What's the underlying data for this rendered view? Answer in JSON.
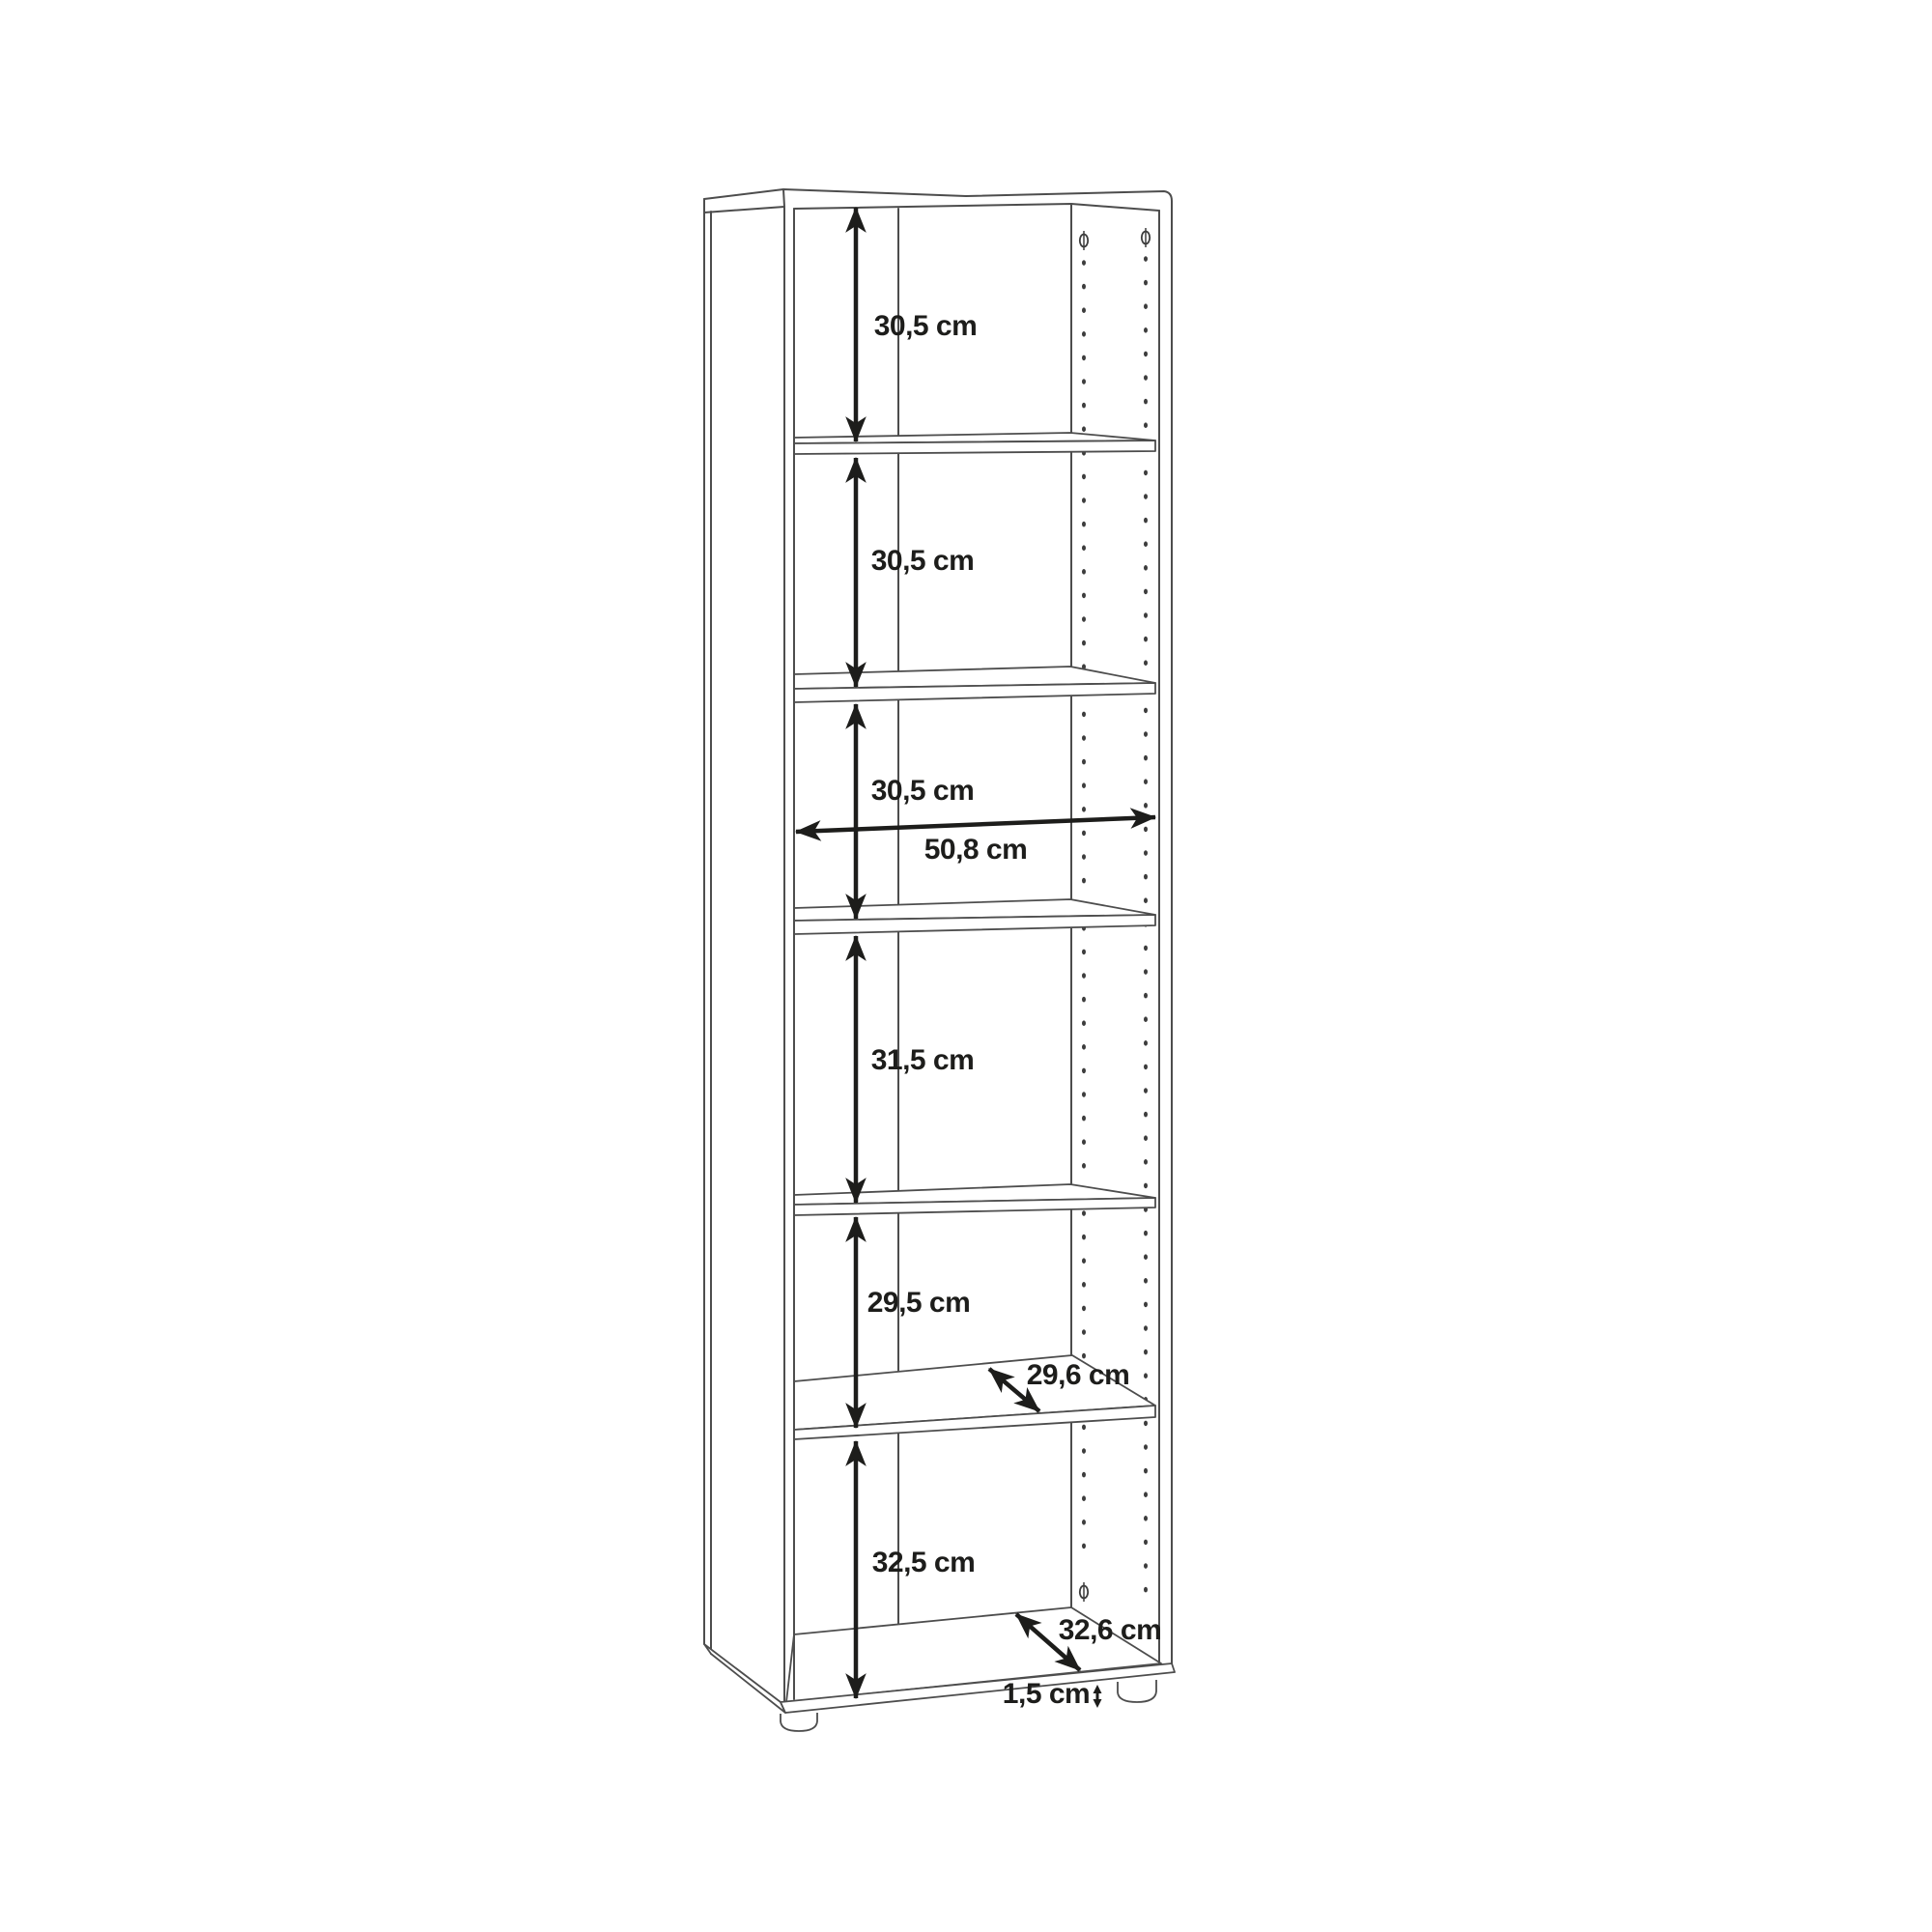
{
  "page": {
    "background": "#ffffff"
  },
  "diagram": {
    "subject": "bookcase-dimension-drawing",
    "line_color": "#4d4d4d",
    "dimension_color": "#1d1d1b",
    "shelf_count": 5,
    "dimensions": {
      "compartment_heights": [
        "30,5 cm",
        "30,5 cm",
        "30,5 cm",
        "31,5 cm",
        "29,5 cm",
        "32,5 cm"
      ],
      "inner_width": "50,8 cm",
      "shelf_depth": "29,6 cm",
      "bottom_depth": "32,6 cm",
      "foot_height": "1,5 cm"
    }
  }
}
